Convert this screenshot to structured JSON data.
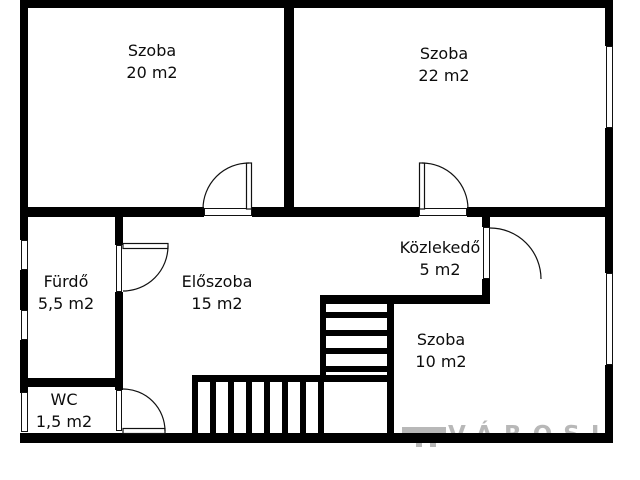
{
  "rooms": [
    {
      "id": "szoba20",
      "name": "Szoba",
      "area": "20 m2"
    },
    {
      "id": "szoba22",
      "name": "Szoba",
      "area": "22 m2"
    },
    {
      "id": "furdo",
      "name": "Fürdő",
      "area": "5,5 m2"
    },
    {
      "id": "eloszoba",
      "name": "Előszoba",
      "area": "15 m2"
    },
    {
      "id": "kozlekedo",
      "name": "Közlekedő",
      "area": "5 m2"
    },
    {
      "id": "szoba10",
      "name": "Szoba",
      "area": "10 m2"
    },
    {
      "id": "wc",
      "name": "WC",
      "area": "1,5 m2"
    }
  ],
  "watermark": {
    "text": "VÁROSI"
  },
  "colors": {
    "wall": "#000000",
    "background": "#ffffff",
    "watermark": "#b8b8b8"
  }
}
